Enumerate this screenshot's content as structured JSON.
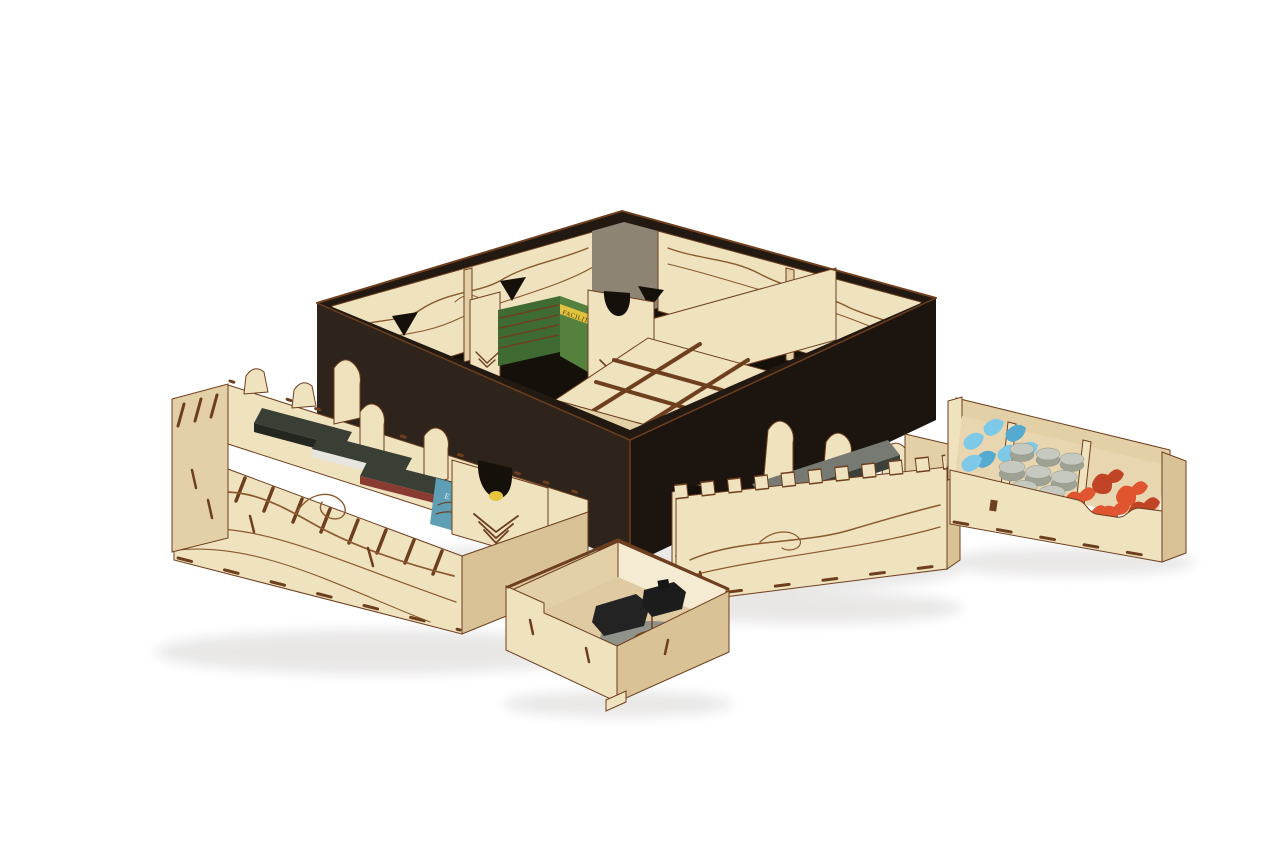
{
  "image": {
    "description": "Product photograph on a white background: a laser-cut plywood board game organizer. A black game box holds engraved wooden insert walls with wave patterns and triangular cutouts, a card channel with a green FACILITY card stack, and a low compartment grid. Around it sit five removable wooden trays: a long card tray with dark sleeved card stacks and a teal E HAGA card, a second card tray with gray sleeved stacks and a red card, a small tray with a gray round token and black ship piece, and a three-bin tray holding blue petal tokens, gray discs and orange pieces."
  },
  "labels": {
    "facility_card": "FACILITY",
    "haga_card": "E HÁGA"
  },
  "colors": {
    "wood_light": "#efe2bf",
    "wood_light2": "#f5ebd2",
    "wood_mid": "#e3d0a7",
    "wood_side": "#d8c296",
    "burn_edge": "#6e3f1f",
    "engrave": "#8a5a2e",
    "box_dark": "#2e241c",
    "box_darker": "#221912",
    "box_darkest": "#1c140e",
    "box_inner_gray": "#8d8474",
    "interior_dark": "#16100a",
    "card_green": "#55813f",
    "card_green_dark": "#3f6a33",
    "card_yellow": "#e2c23e",
    "card_blue": "#5f9fb5",
    "card_red": "#8a3b31",
    "card_white": "#e6e5df",
    "sleeve_dark": "#3a3f36",
    "sleeve_gray": "#767a72",
    "piece_blue": "#7ec8e8",
    "piece_blue_dark": "#54aacf",
    "piece_gray": "#c6c9c0",
    "piece_gray_dark": "#9ea295",
    "piece_orange": "#e0552f",
    "piece_orange_dark": "#c24426",
    "piece_yellow": "#e7c53e",
    "token_gray": "#90938a",
    "piece_black": "#232323",
    "marker_yellow": "#e9b93a",
    "shadow": "#2a2118",
    "background": "#ffffff"
  },
  "scene": {
    "items": [
      "game-box",
      "insert-wave-panel",
      "shark-fin-cutout",
      "facility-card-stack",
      "insert-bottom-grid",
      "left-card-tray",
      "sleeved-card-stack",
      "white-card-stack",
      "haga-card",
      "u-notch-panel",
      "chevron-engraving",
      "middle-card-tray",
      "red-card",
      "yellow-piece",
      "small-token-tray",
      "token-disc",
      "black-ship-piece",
      "right-bits-tray",
      "blue-petal-pieces",
      "gray-disc-pieces",
      "orange-pieces"
    ]
  }
}
